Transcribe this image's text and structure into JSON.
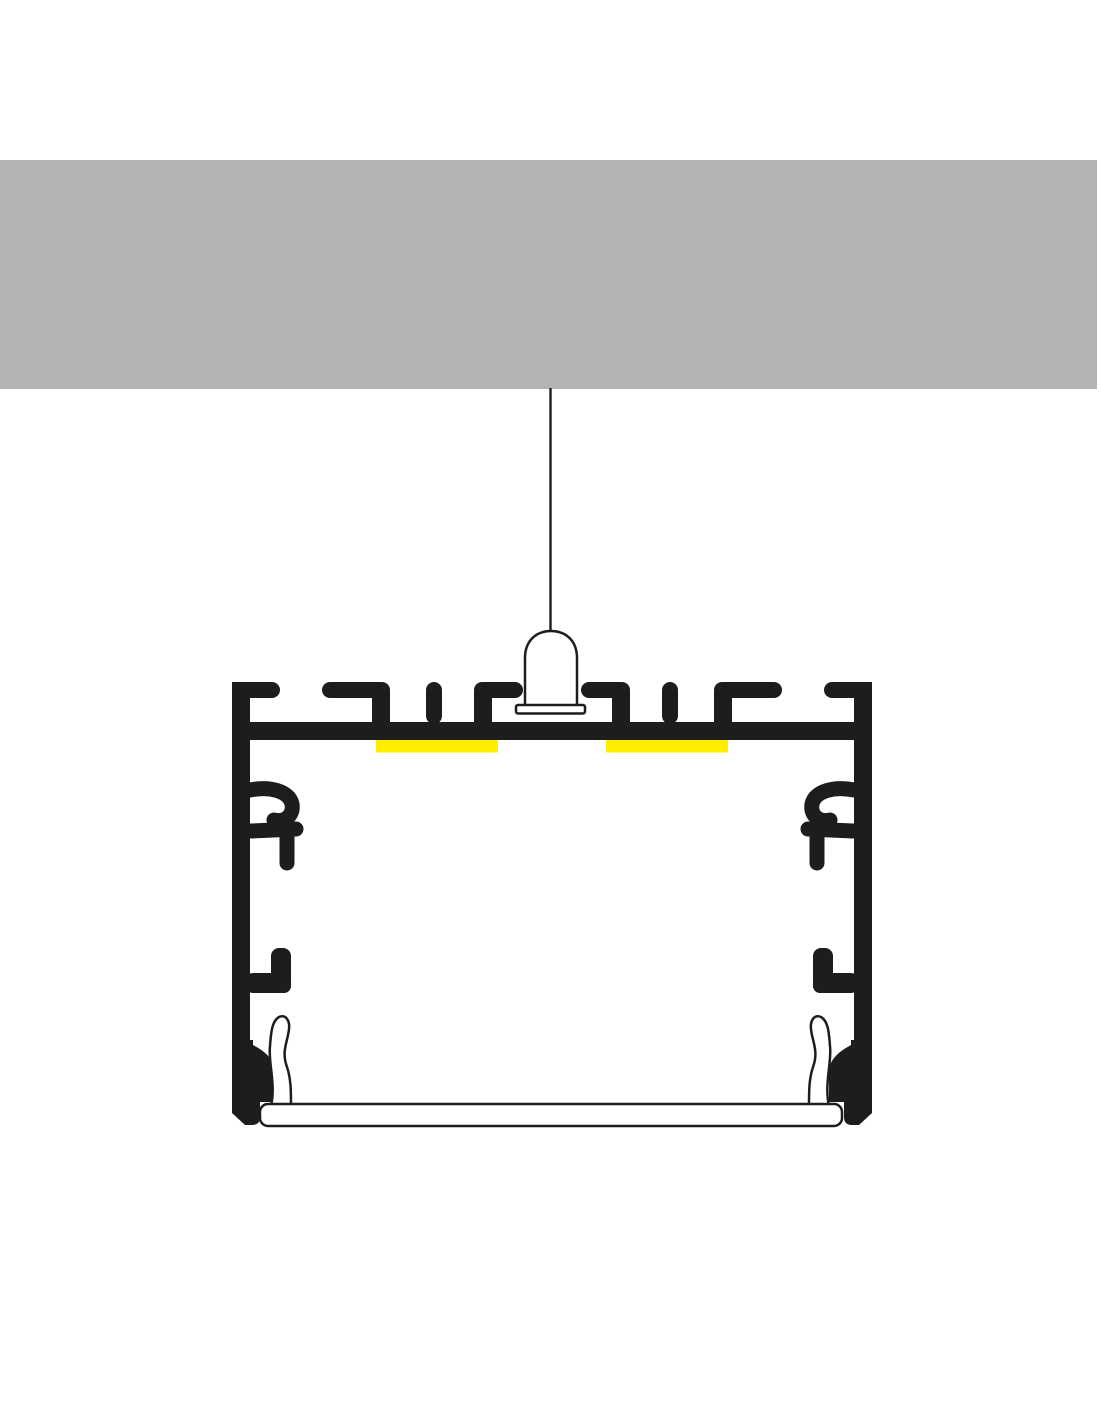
{
  "diagram": {
    "type": "technical-cross-section",
    "subject": "suspended-led-aluminium-profile-mounting-diagram",
    "parts": [
      {
        "id": "ceiling",
        "label": "ceiling-slab"
      },
      {
        "id": "suspension-wire",
        "label": "suspension-wire"
      },
      {
        "id": "suspension-mount",
        "label": "suspension-holder"
      },
      {
        "id": "profile-body",
        "label": "aluminium-profile-cross-section"
      },
      {
        "id": "led-strip-left",
        "label": "led-strip"
      },
      {
        "id": "led-strip-right",
        "label": "led-strip"
      },
      {
        "id": "diffuser-cover",
        "label": "diffuser-cover"
      }
    ],
    "colors": {
      "background": "#ffffff",
      "ceiling_gray": "#b3b3b3",
      "profile_black": "#1d1d1b",
      "led_yellow": "#ffed00",
      "cover_white": "#ffffff"
    }
  }
}
